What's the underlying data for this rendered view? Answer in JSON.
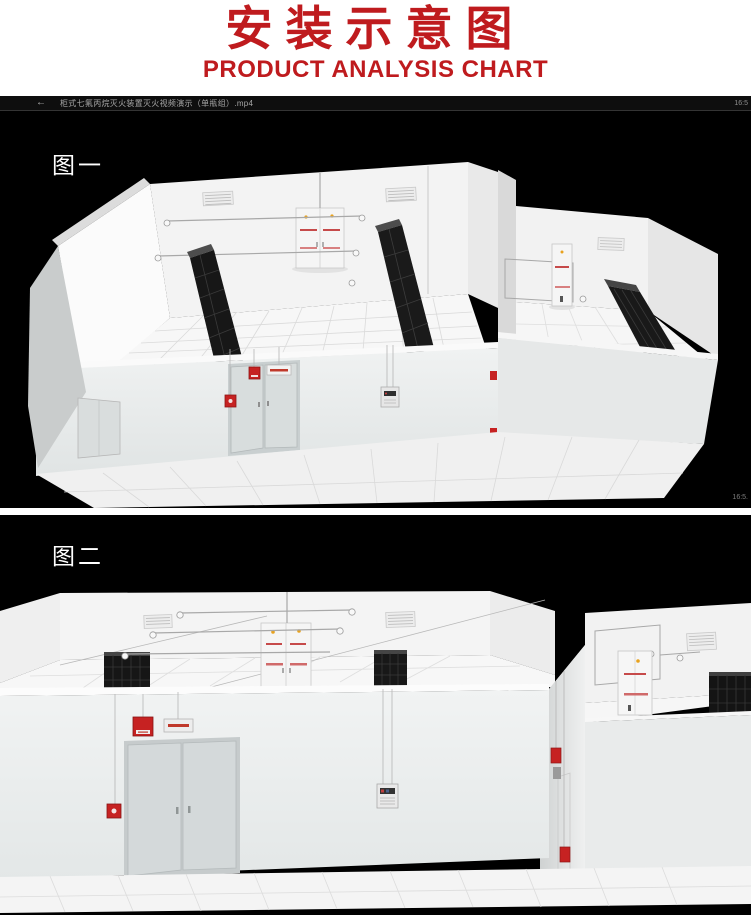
{
  "header": {
    "title": "安装示意图",
    "subtitle": "PRODUCT ANALYSIS CHART",
    "accent_color": "#bf1b1e"
  },
  "player": {
    "back_icon": "←",
    "filename": "柜式七氟丙烷灭火装置灭火视频演示（单瓶组）.mp4",
    "clock": "16:5",
    "corner_timestamp": "16:5."
  },
  "figure1": {
    "label": "图一"
  },
  "figure2": {
    "label": "图二"
  },
  "colors": {
    "background": "#000000",
    "wall_white": "#f3f3f3",
    "rack_dark": "#161616",
    "alarm_red": "#c62222",
    "indicator_yellow": "#e8a21e"
  }
}
